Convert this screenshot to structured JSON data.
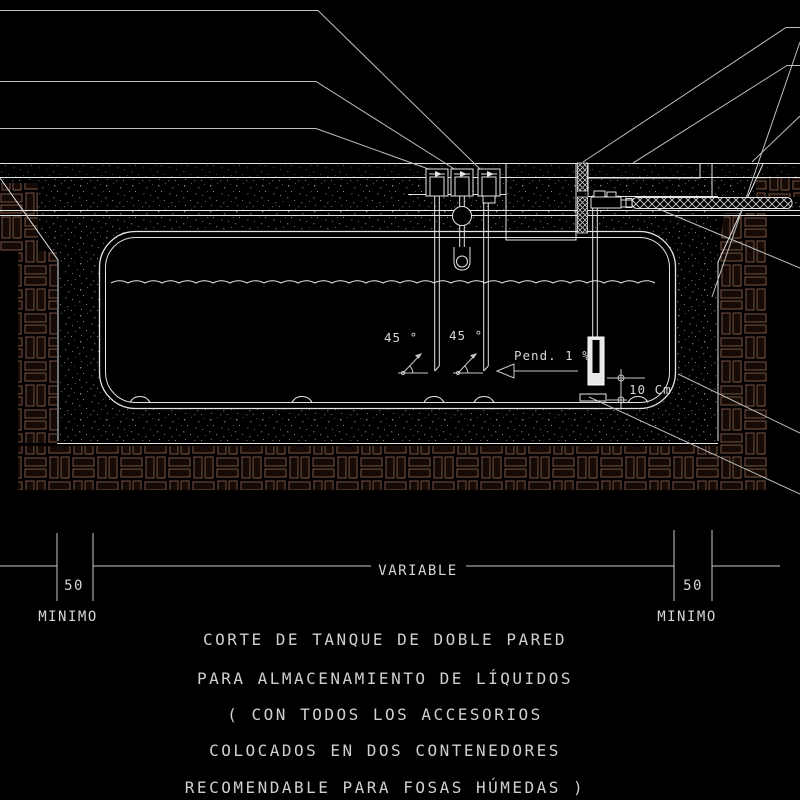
{
  "drawing": {
    "labels": {
      "angle_left": "45 °",
      "angle_right": "45 °",
      "slope": "Pend. 1 %",
      "clearance": "10 Cm"
    },
    "dimensions": {
      "left_value": "50",
      "left_caption": "MINIMO",
      "center_caption": "VARIABLE",
      "right_value": "50",
      "right_caption": "MINIMO"
    },
    "title_lines": [
      "CORTE DE TANQUE DE DOBLE PARED",
      "PARA ALMACENAMIENTO DE LÍQUIDOS",
      "( CON TODOS LOS ACCESORIOS",
      "COLOCADOS EN DOS CONTENEDORES",
      "RECOMENDABLE PARA FOSAS HÚMEDAS )"
    ],
    "colors": {
      "background": "#000000",
      "line": "#e4e4e4",
      "dim_line": "#c9c9c9",
      "text": "#d6d6d6",
      "water": "#a6906f",
      "brick_stroke": "#7d5340",
      "brick_fill": "#150b06"
    }
  }
}
